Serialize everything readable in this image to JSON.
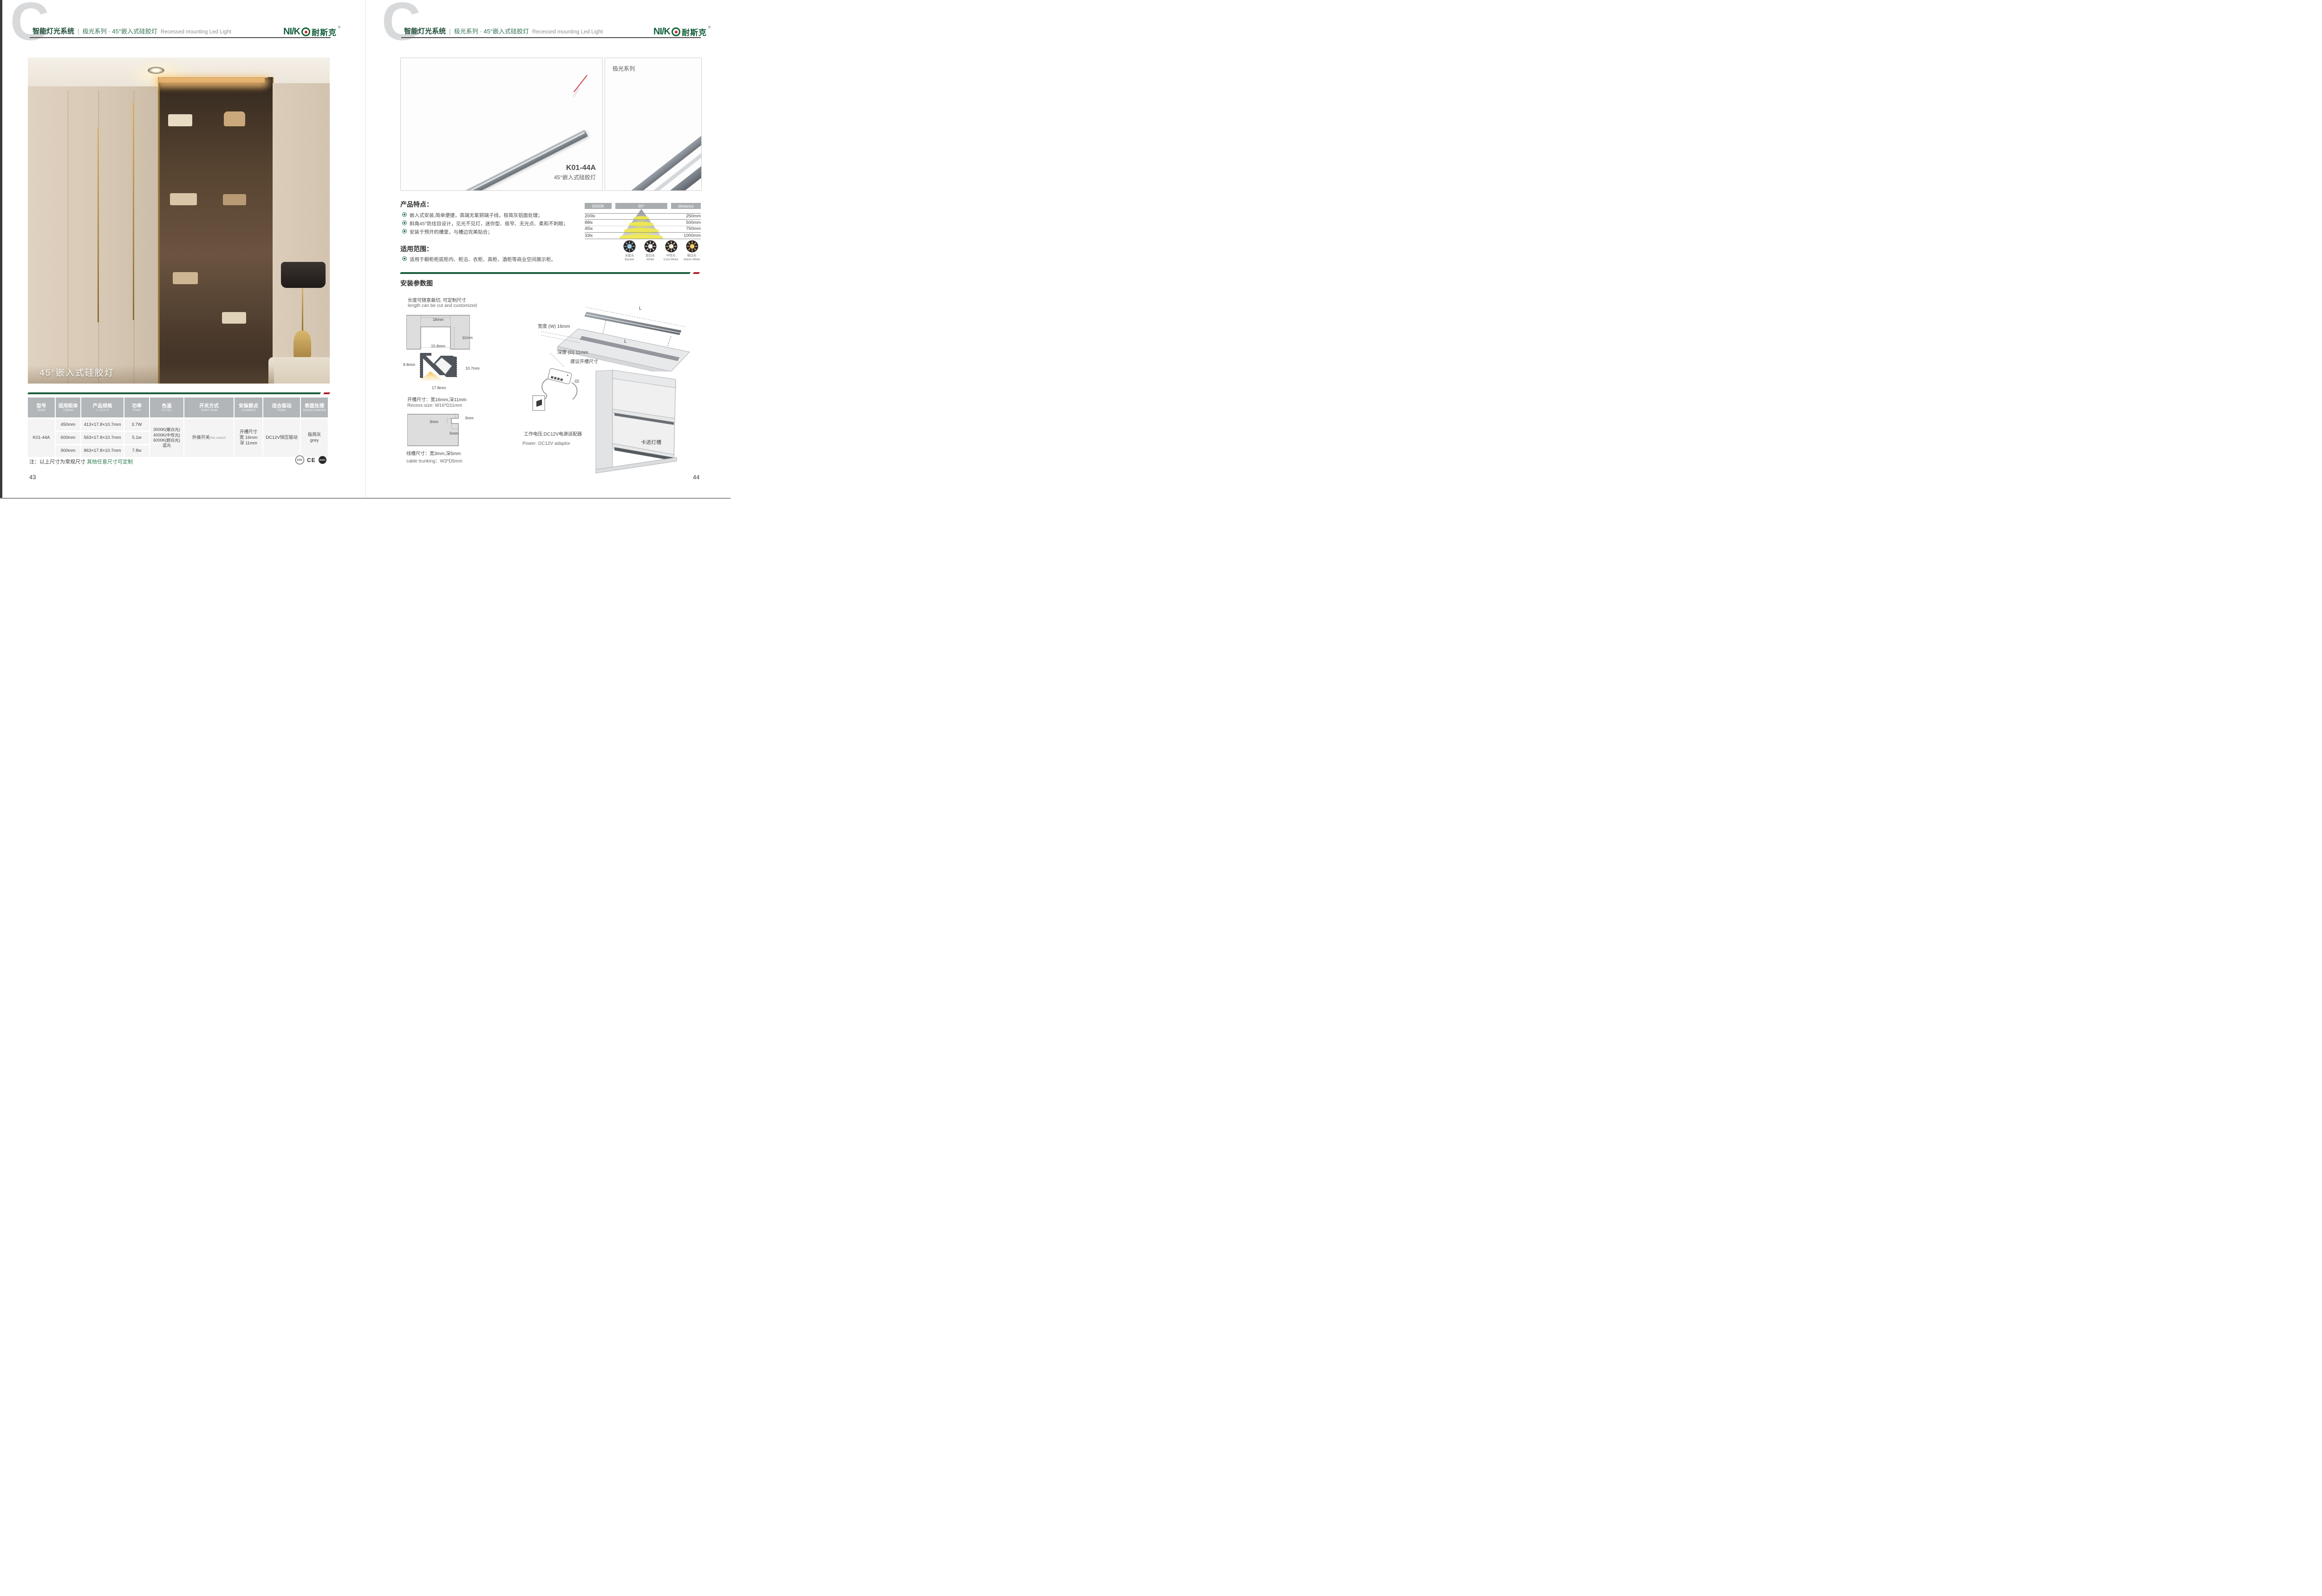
{
  "colors": {
    "brand_green": "#15603c",
    "accent_red": "#b2252b",
    "divider_green": "#1d5f3e",
    "table_header_gray": "#b2b6b9"
  },
  "header": {
    "title_cn": "智能灯光系统",
    "separator": "|",
    "series": "极光系列 · 45°嵌入式硅胶灯",
    "subtitle_en": "Recessed mounting Led Light",
    "logo_en": "NI/K",
    "logo_cn": "耐斯克",
    "logo_reg": "®"
  },
  "left_page": {
    "photo_caption": "45°嵌入式硅胶灯",
    "table": {
      "headers": [
        {
          "cn": "型号",
          "en": "Model"
        },
        {
          "cn": "适用柜体",
          "en": "Cabinet"
        },
        {
          "cn": "产品规格",
          "en": "L x D x H"
        },
        {
          "cn": "功率",
          "en": "Power"
        },
        {
          "cn": "色温",
          "en": "CCT(K)"
        },
        {
          "cn": "开关方式",
          "en": "Switch mode"
        },
        {
          "cn": "安装要点",
          "en": "Installation"
        },
        {
          "cn": "适合驱动",
          "en": "Power"
        },
        {
          "cn": "表面处理",
          "en": "Surface treatment"
        }
      ],
      "model": "K01-44A",
      "rows": [
        {
          "cabinet": "450mm",
          "spec": "413×17.8×10.7mm",
          "power": "3.7W"
        },
        {
          "cabinet": "600mm",
          "spec": "563×17.8×10.7mm",
          "power": "5.1w"
        },
        {
          "cabinet": "900mm",
          "spec": "863×17.8×10.7mm",
          "power": "7.8w"
        }
      ],
      "cct_lines": [
        "3000K(暖白光)",
        "4000K(中性光)",
        "6000K(超白光)",
        "蓝光"
      ],
      "switch_cn": "外接开关",
      "switch_en": "/No switch",
      "install_lines": [
        "开槽尺寸",
        "宽 16mm",
        "深 11mm"
      ],
      "drive": "DC12V恒压驱动",
      "surface_cn": "极简灰",
      "surface_en": "grey"
    },
    "note_prefix": "注：以上尺寸为常规尺寸 ",
    "note_green": "其他任意尺寸可定制",
    "certs": [
      "CCC",
      "CE",
      "RoHS"
    ],
    "page_no": "43"
  },
  "right_page": {
    "product": {
      "model": "K01-44A",
      "name": "45°嵌入式硅胶灯",
      "series_label": "极光系列"
    },
    "features": {
      "title": "产品特点：",
      "items": [
        "嵌入式安装,简单便捷，高端无氧铜端子线，极简灰铝面处理；",
        "斜角45°防炫目设计，见光不见灯，迷你型、极窄、无光点、柔和不刺眼；",
        "安装于预开的槽里，与槽边完美贴合；"
      ]
    },
    "scope": {
      "title": "适用范围：",
      "items": [
        "适用于橱柜柜底柜内、柜沿、衣柜、高柜、酒柜等商业空间展示柜。"
      ]
    },
    "light_chart": {
      "cct": "6500K",
      "angle": "90°",
      "distance_label": "distance",
      "rows": [
        {
          "lux": "200lx",
          "distance": "250mm"
        },
        {
          "lux": "88lx",
          "distance": "500mm"
        },
        {
          "lux": "45lx",
          "distance": "750mm"
        },
        {
          "lux": "33lx",
          "distance": "1000mm"
        }
      ]
    },
    "cct_icons": [
      {
        "cn": "冰蓝光",
        "en": "Basket",
        "color": "#9fd3ee"
      },
      {
        "cn": "超白光",
        "en": "White",
        "color": "#ffffff"
      },
      {
        "cn": "中性光",
        "en": "Cool White",
        "color": "#f6edd4"
      },
      {
        "cn": "暖白光",
        "en": "Warm White",
        "color": "#f3c96f"
      }
    ],
    "install": {
      "title": "安装参数图",
      "cut_note_cn": "长度可随意裁切, 可定制尺寸",
      "cut_note_en": "length can be cut and customized",
      "recess_dims": {
        "top": "16mm",
        "right": "11mm",
        "inner": "15.8mm",
        "left": "9.8mm",
        "profile_right": "10.7mm",
        "bottom": "17.8mm"
      },
      "recess_text_cn": "开槽尺寸：宽16mm,深11mm",
      "recess_text_en": "Recess size: W16*D11mm",
      "trunk_dims": {
        "top": "3mm",
        "left": "3mm",
        "bottom": "5mm"
      },
      "trunk_text_cn": "线槽尺寸：宽3mm,深5mm",
      "trunk_text_en": "cable trunking：W3*D5mm",
      "board": {
        "l_top": "L",
        "l_board": "L",
        "width_label": "宽度 (W) 16mm",
        "depth_label": "深度 (D) 11mm",
        "caption": "建议开槽尺寸"
      },
      "power_cn": "工作电压:DC12V电源适配器",
      "power_en": "Power: DC12V adaptor",
      "clip_label": "卡进灯槽"
    },
    "page_no": "44"
  }
}
